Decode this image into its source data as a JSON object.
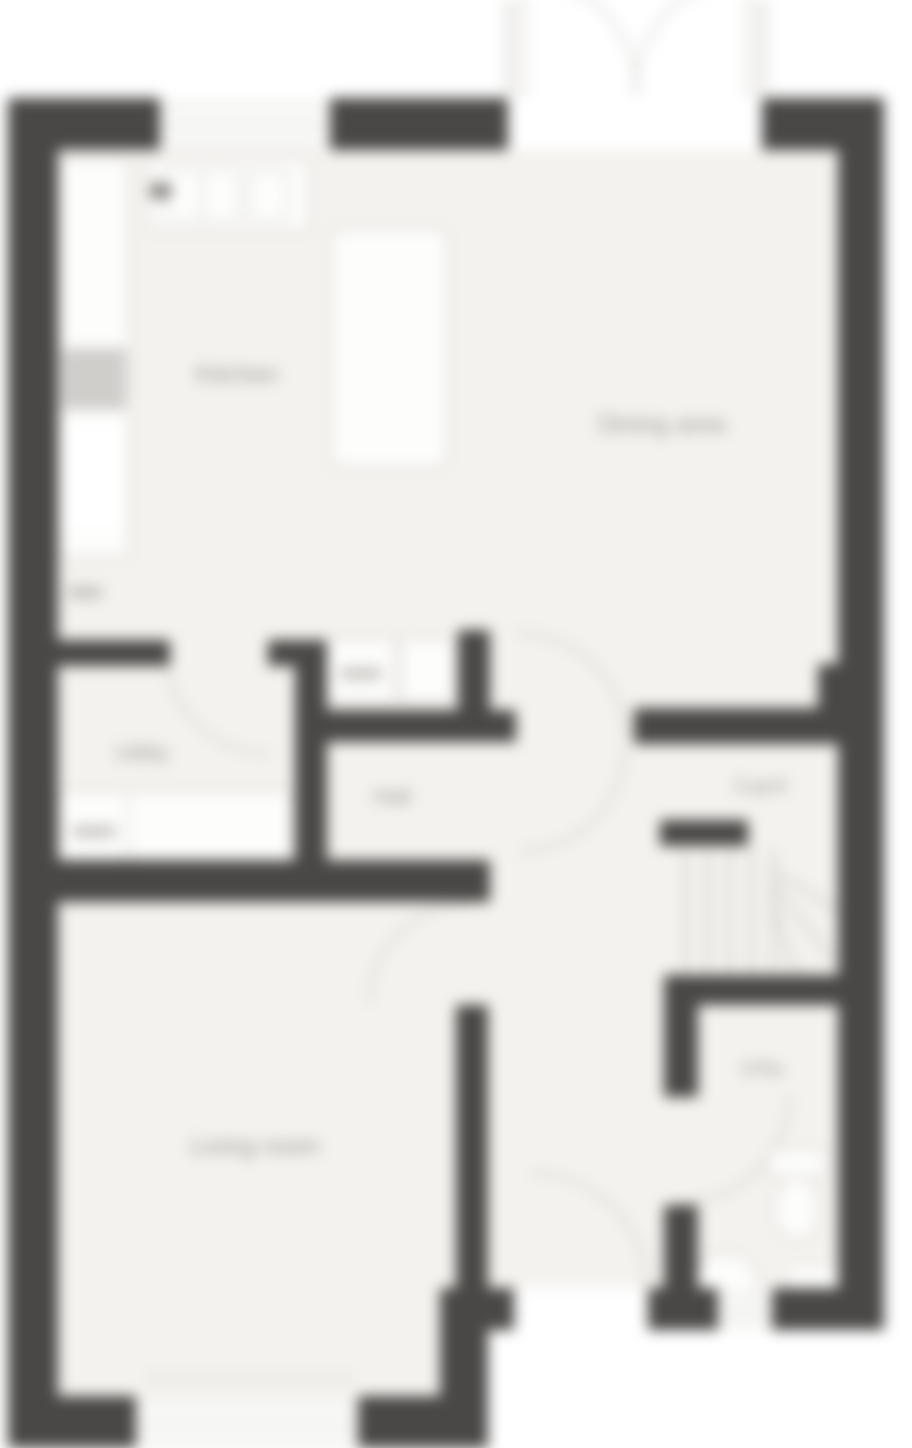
{
  "plan": {
    "title": "Ground floor plan",
    "rooms": {
      "kitchen": {
        "label": "Kitchen"
      },
      "dining_area": {
        "label": "Dining area"
      },
      "utility": {
        "label": "Utility"
      },
      "hall": {
        "label": "Hall"
      },
      "cupboard": {
        "label": "Cup'd"
      },
      "living_room": {
        "label": "Living room"
      },
      "cloaks": {
        "label": "Cl'ks"
      }
    },
    "fixtures": [
      {
        "name": "kitchen-sink-unit"
      },
      {
        "name": "oven-housing"
      },
      {
        "name": "fridge-freezer"
      },
      {
        "name": "kitchen-peninsula"
      },
      {
        "name": "appliance-units"
      },
      {
        "name": "utility-worktop"
      },
      {
        "name": "staircase"
      },
      {
        "name": "toilet"
      },
      {
        "name": "washbasin"
      },
      {
        "name": "radiator"
      },
      {
        "name": "french-doors"
      },
      {
        "name": "front-door"
      }
    ],
    "colors": {
      "wall": "#4a4846",
      "floor": "#f4f2ee",
      "fixture_outline": "#d5d3cf",
      "fixture_fill": "#fdfdfc",
      "door_arc": "#c6c4c0",
      "label_text": "#9c9a96",
      "window_glaze": "#fafaf8",
      "background": "#ffffff"
    }
  }
}
